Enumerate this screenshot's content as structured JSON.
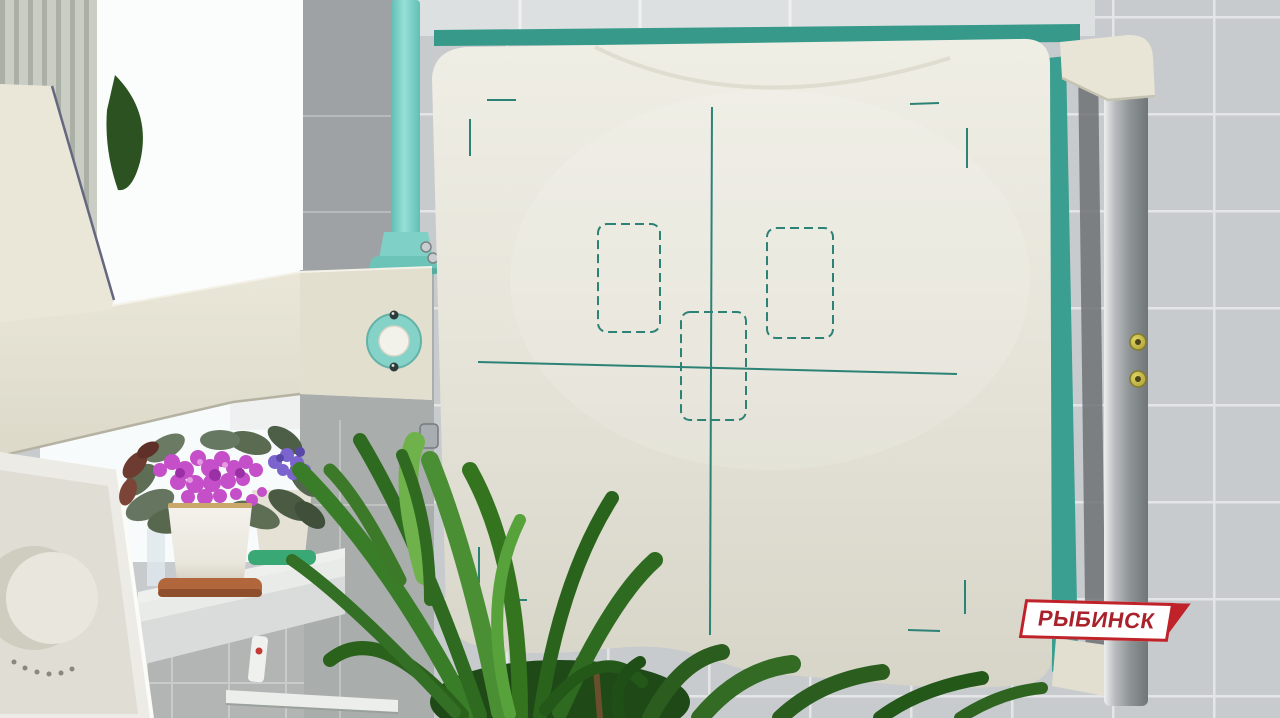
{
  "overlay": {
    "watermark_text": "РЫБИНСК",
    "watermark_bg": "#ffffff",
    "watermark_red": "#bf2329",
    "watermark_text_color": "#a9212a"
  },
  "scene": {
    "setting": "x-ray room with flat-panel detector, window, plants and tiled wall",
    "objects": [
      "x-ray detector panel",
      "teal alignment markings",
      "support arm",
      "teal support column",
      "metal handle rail",
      "window",
      "potted violets",
      "green houseplant",
      "windowsill",
      "tiled wall",
      "control dial device",
      "heating pipe"
    ],
    "colors": {
      "tile_gray": "#c8cbce",
      "tile_grout": "#e3e5e6",
      "dark_tile": "#9ea2a4",
      "window_white": "#fbfdfd",
      "machine_cream": "#eae7d9",
      "machine_cream_shadow": "#dcd9c9",
      "teal_accent": "#85d2c8",
      "panel_trim_teal": "#37998a",
      "marking_teal": "#2d8276",
      "rail_silver": "#a9aeb0",
      "gold_button": "#c2b648",
      "flower_magenta": "#c44fc8",
      "flower_violet": "#7b64cd",
      "leaf_green": "#3a7d28",
      "sill_white": "#eef0ee",
      "saucer_terracotta": "#b2663c"
    }
  }
}
